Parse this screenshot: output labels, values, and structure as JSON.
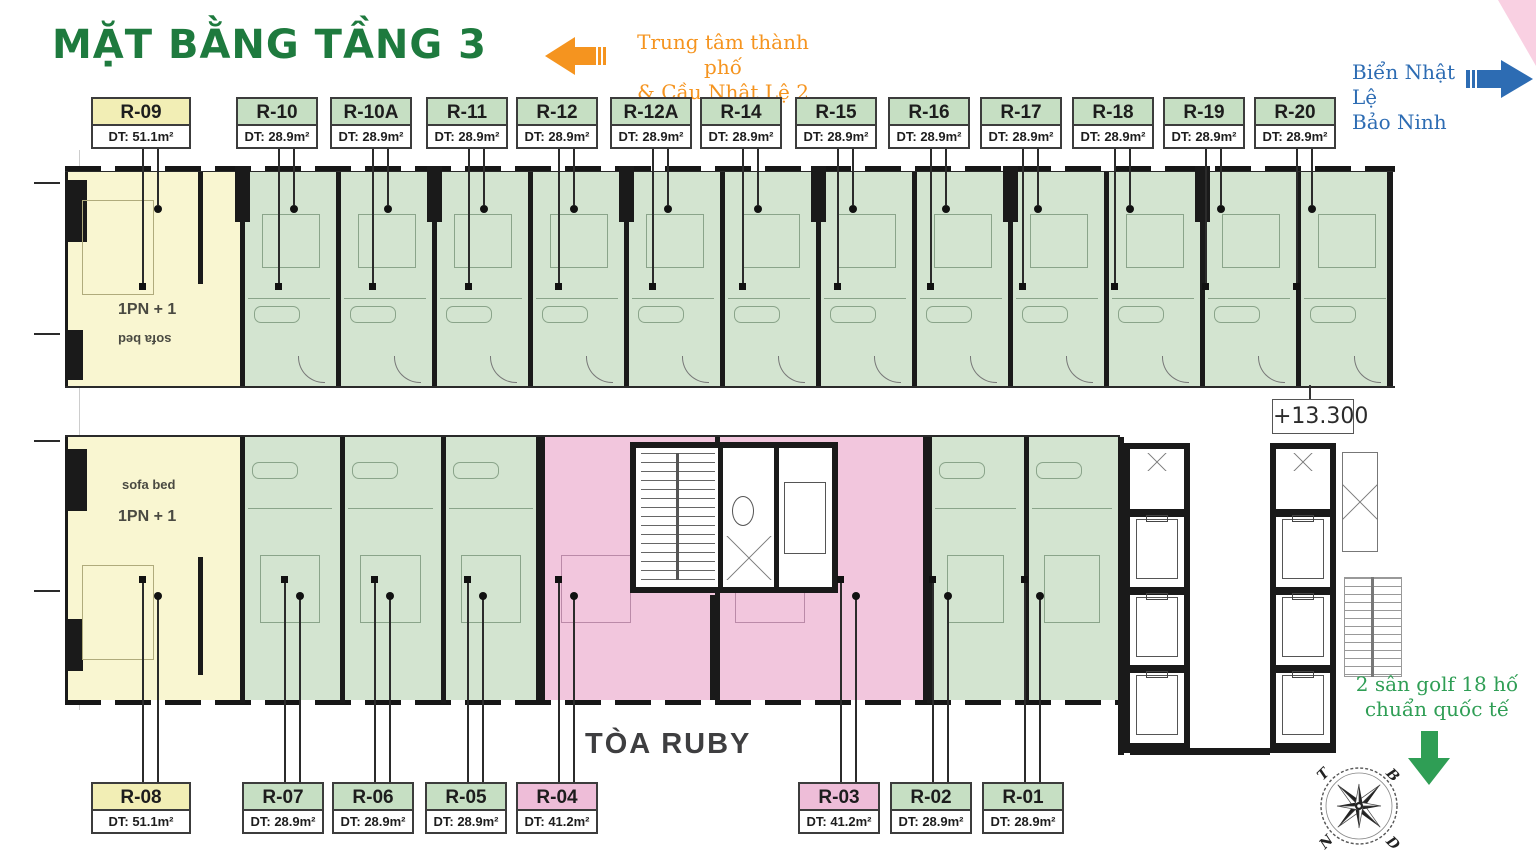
{
  "title": "MẶT BẰNG TẦNG 3",
  "building_label": "TÒA RUBY",
  "level_marker": "+13.300",
  "directions": {
    "city": {
      "line1": "Trung tâm thành phố",
      "line2": "& Cầu Nhật Lệ 2"
    },
    "beach": {
      "line1": "Biển Nhật Lệ",
      "line2": "Bảo Ninh"
    },
    "golf": {
      "line1": "2 sân golf 18 hố",
      "line2": "chuẩn quốc tế"
    }
  },
  "compass": {
    "top_left": "T",
    "top_right": "B",
    "bottom_left": "N",
    "bottom_right": "D"
  },
  "unit_annotations": {
    "type_label": "1PN + 1",
    "sofa_label": "sofa bed"
  },
  "top_units": [
    {
      "id": "R-09",
      "area": "DT: 51.1m²",
      "color": "yellow"
    },
    {
      "id": "R-10",
      "area": "DT: 28.9m²",
      "color": "green"
    },
    {
      "id": "R-10A",
      "area": "DT: 28.9m²",
      "color": "green"
    },
    {
      "id": "R-11",
      "area": "DT: 28.9m²",
      "color": "green"
    },
    {
      "id": "R-12",
      "area": "DT: 28.9m²",
      "color": "green"
    },
    {
      "id": "R-12A",
      "area": "DT: 28.9m²",
      "color": "green"
    },
    {
      "id": "R-14",
      "area": "DT: 28.9m²",
      "color": "green"
    },
    {
      "id": "R-15",
      "area": "DT: 28.9m²",
      "color": "green"
    },
    {
      "id": "R-16",
      "area": "DT: 28.9m²",
      "color": "green"
    },
    {
      "id": "R-17",
      "area": "DT: 28.9m²",
      "color": "green"
    },
    {
      "id": "R-18",
      "area": "DT: 28.9m²",
      "color": "green"
    },
    {
      "id": "R-19",
      "area": "DT: 28.9m²",
      "color": "green"
    },
    {
      "id": "R-20",
      "area": "DT: 28.9m²",
      "color": "green"
    }
  ],
  "bottom_units": [
    {
      "id": "R-08",
      "area": "DT: 51.1m²",
      "color": "yellow"
    },
    {
      "id": "R-07",
      "area": "DT: 28.9m²",
      "color": "green"
    },
    {
      "id": "R-06",
      "area": "DT: 28.9m²",
      "color": "green"
    },
    {
      "id": "R-05",
      "area": "DT: 28.9m²",
      "color": "green"
    },
    {
      "id": "R-04",
      "area": "DT: 41.2m²",
      "color": "pink"
    },
    {
      "id": "R-03",
      "area": "DT: 41.2m²",
      "color": "pink"
    },
    {
      "id": "R-02",
      "area": "DT: 28.9m²",
      "color": "green"
    },
    {
      "id": "R-01",
      "area": "DT: 28.9m²",
      "color": "green"
    }
  ],
  "colors": {
    "unit_green": "#d3e4d0",
    "unit_yellow": "#f9f6d1",
    "unit_pink": "#f2c6dd",
    "label_green": "#c6dfc3",
    "label_yellow": "#f2eeb5",
    "label_pink": "#eebdd8",
    "title_green": "#1e7a3e",
    "orange": "#f5941f",
    "blue": "#2d6cb3",
    "golf_green": "#2f9e55",
    "wall": "#1a1a1a",
    "furniture_line": "#8aa48a",
    "dark_text": "#3e3e40"
  }
}
